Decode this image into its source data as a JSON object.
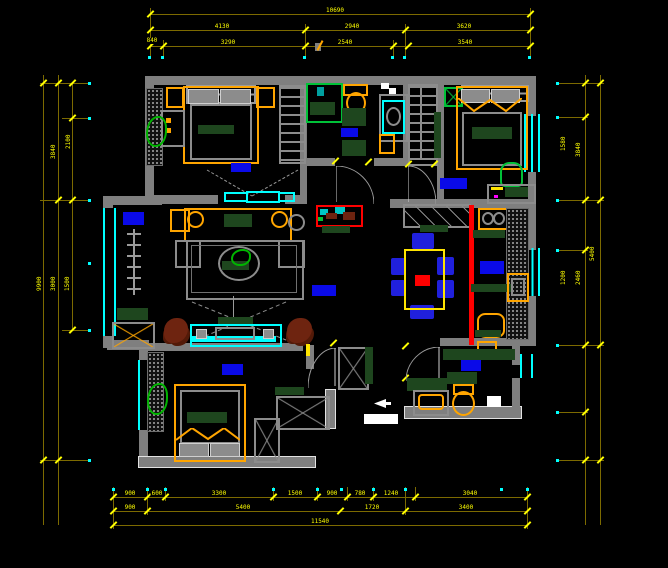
{
  "drawing": {
    "type": "residential-floor-plan-cad",
    "background": "#000000",
    "room_label_blocks": {
      "style": "solid-blue-rectangle",
      "color": "#0a0ae8",
      "count": 8
    }
  },
  "palette": {
    "wall": "#7f7f7f",
    "window": "#00ffff",
    "dimension_line": "#7c6a00",
    "dimension_text": "#ffff00",
    "furniture_accent": "#ffa500",
    "soft_furnishing_green": "#1e461e",
    "label_block_blue": "#0a0ae8",
    "track_marker_red": "#ff0000",
    "plant_green": "#00b400",
    "axis_dot": "#00ffff",
    "entry_marker": "#ffffff"
  },
  "fixtures": [
    "double-bed",
    "nightstand",
    "dresser",
    "wardrobe",
    "walk-in-closet",
    "plant",
    "sliding-door",
    "shower",
    "toilet",
    "washing-machine",
    "water-heater",
    "sofa",
    "coffee-table",
    "tv-cabinet",
    "rug",
    "plant-stand",
    "dining-table",
    "dining-chair",
    "sideboard",
    "gas-stove",
    "kitchen-sink",
    "counter",
    "vanity-basin",
    "shoe-cabinet",
    "desk",
    "desk-chair",
    "door-swing",
    "window",
    "entry-arrow"
  ],
  "dimensions": {
    "unit": "mm",
    "top": {
      "overall": [
        "10690"
      ],
      "middle": [
        "4130",
        "2940",
        "3620"
      ],
      "inner": [
        "840",
        "3290",
        "2540",
        "3540"
      ]
    },
    "bottom": {
      "inner": [
        "900",
        "600",
        "3300",
        "1500",
        "900",
        "780",
        "1240",
        "3040"
      ],
      "middle": [
        "900",
        "5400",
        "1720",
        "3400"
      ],
      "overall": [
        "11540"
      ]
    },
    "left": [
      "2100",
      "3840",
      "9900",
      "3000",
      "1500"
    ],
    "right": [
      "1580",
      "3840",
      "5400",
      "1200",
      "2460"
    ]
  }
}
